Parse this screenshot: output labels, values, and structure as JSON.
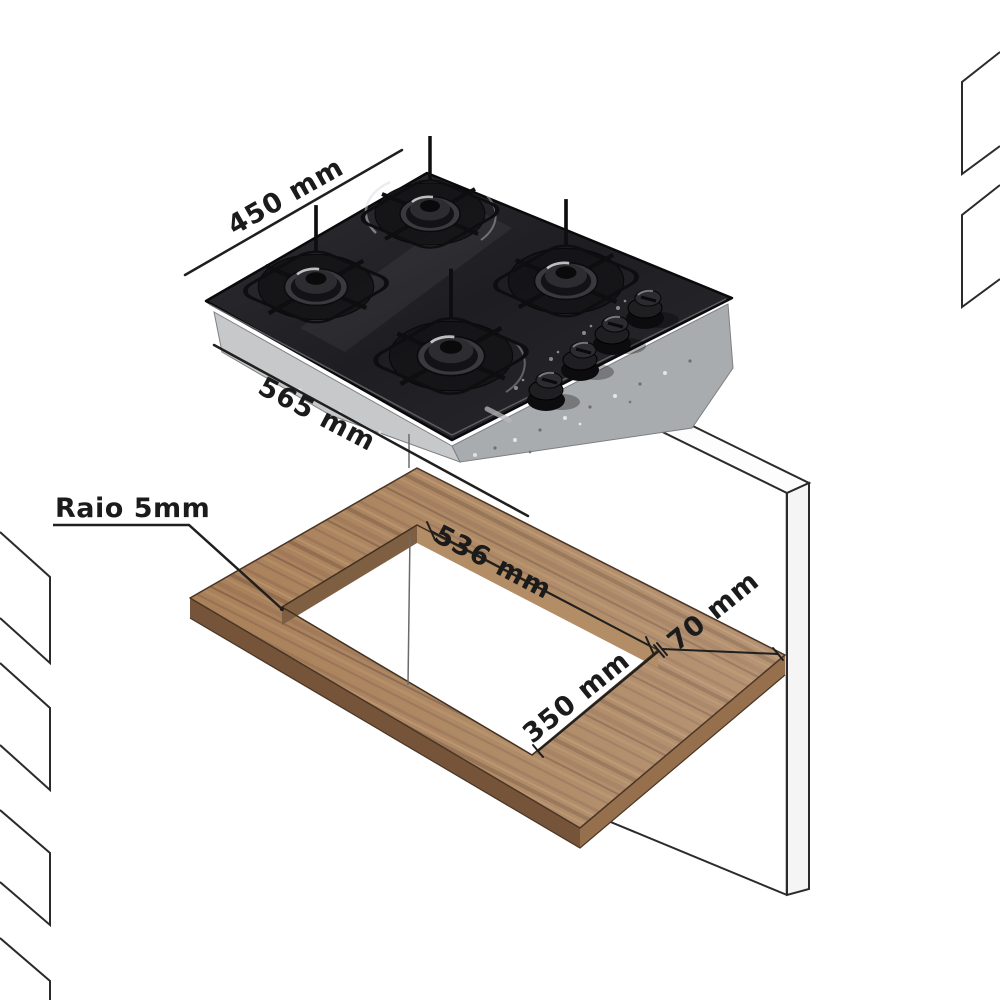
{
  "diagram": {
    "title": "cooktop-installation-diagram",
    "labels": {
      "cooktop_depth": "450 mm",
      "cooktop_width": "565 mm",
      "cutout_width": "536 mm",
      "cutout_depth": "350 mm",
      "edge_distance": "70 mm",
      "corner_radius": "Raio 5mm"
    },
    "colors": {
      "wood": "#a8805a",
      "wood_edge_left": "#75543a",
      "wood_edge_right": "#96704c",
      "glass": "#232327",
      "metal_light": "#c6c8ca",
      "metal_dark": "#a9acaf",
      "line": "#1f1f1f",
      "background": "#ffffff"
    }
  }
}
